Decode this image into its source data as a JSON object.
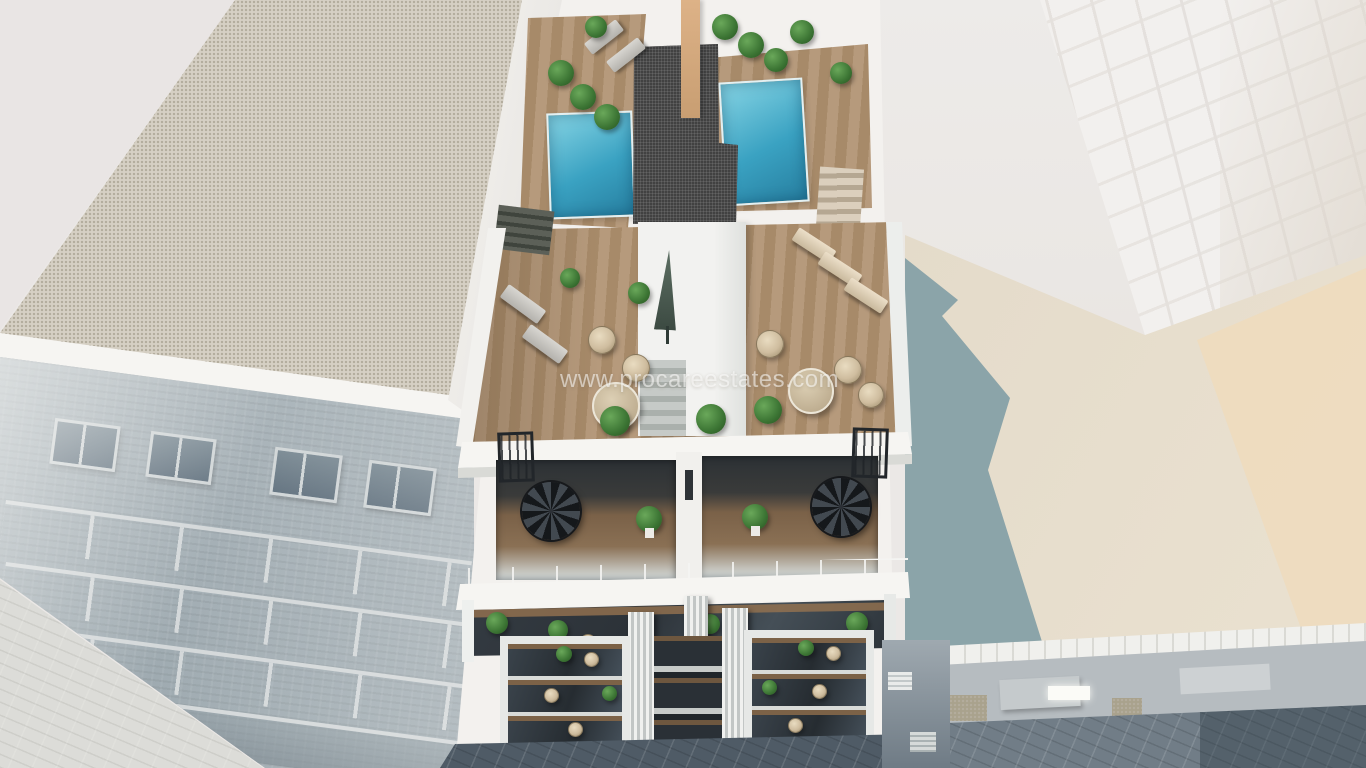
{
  "watermark": {
    "text": "www.procareestates.com"
  },
  "scene": {
    "type": "3d-architectural-render",
    "subject": "aerial view of a modern white apartment building with two rooftop pools, wooden roof terrace, duplex terraces with spiral staircases and balcony facade, between neighboring buildings"
  },
  "colors": {
    "bg_pale": "#ebe8e6",
    "parapet_white": "#f6f5f2",
    "building_white": "#f3f1ee",
    "gravel_roof": "#d6d0c4",
    "gravel_speck": "#b3ac9d",
    "core_gravel": "#383838",
    "tan_wall": "#ddb287",
    "pool_a": "#3aa2c2",
    "pool_b": "#86d4e4",
    "deck_wood_a": "#b69a7c",
    "deck_wood_b": "#a78a69",
    "glass_dark": "#2c3238",
    "plant_a": "#6aa85a",
    "plant_b": "#3c7534",
    "rattan": "#cfbd9f",
    "left_facade_a": "#a7b2b8",
    "left_facade_b": "#8c9aa2",
    "street_light": "#c9c9c3",
    "street_dark": "#4f5b66",
    "plaza_cream": "#e4dbca",
    "plaza_sun": "#eedcbe",
    "plaza_shadow": "#8ba4a9",
    "tower_white": "#f2f0ee",
    "watermark_color": "rgba(255,255,255,0.55)"
  }
}
